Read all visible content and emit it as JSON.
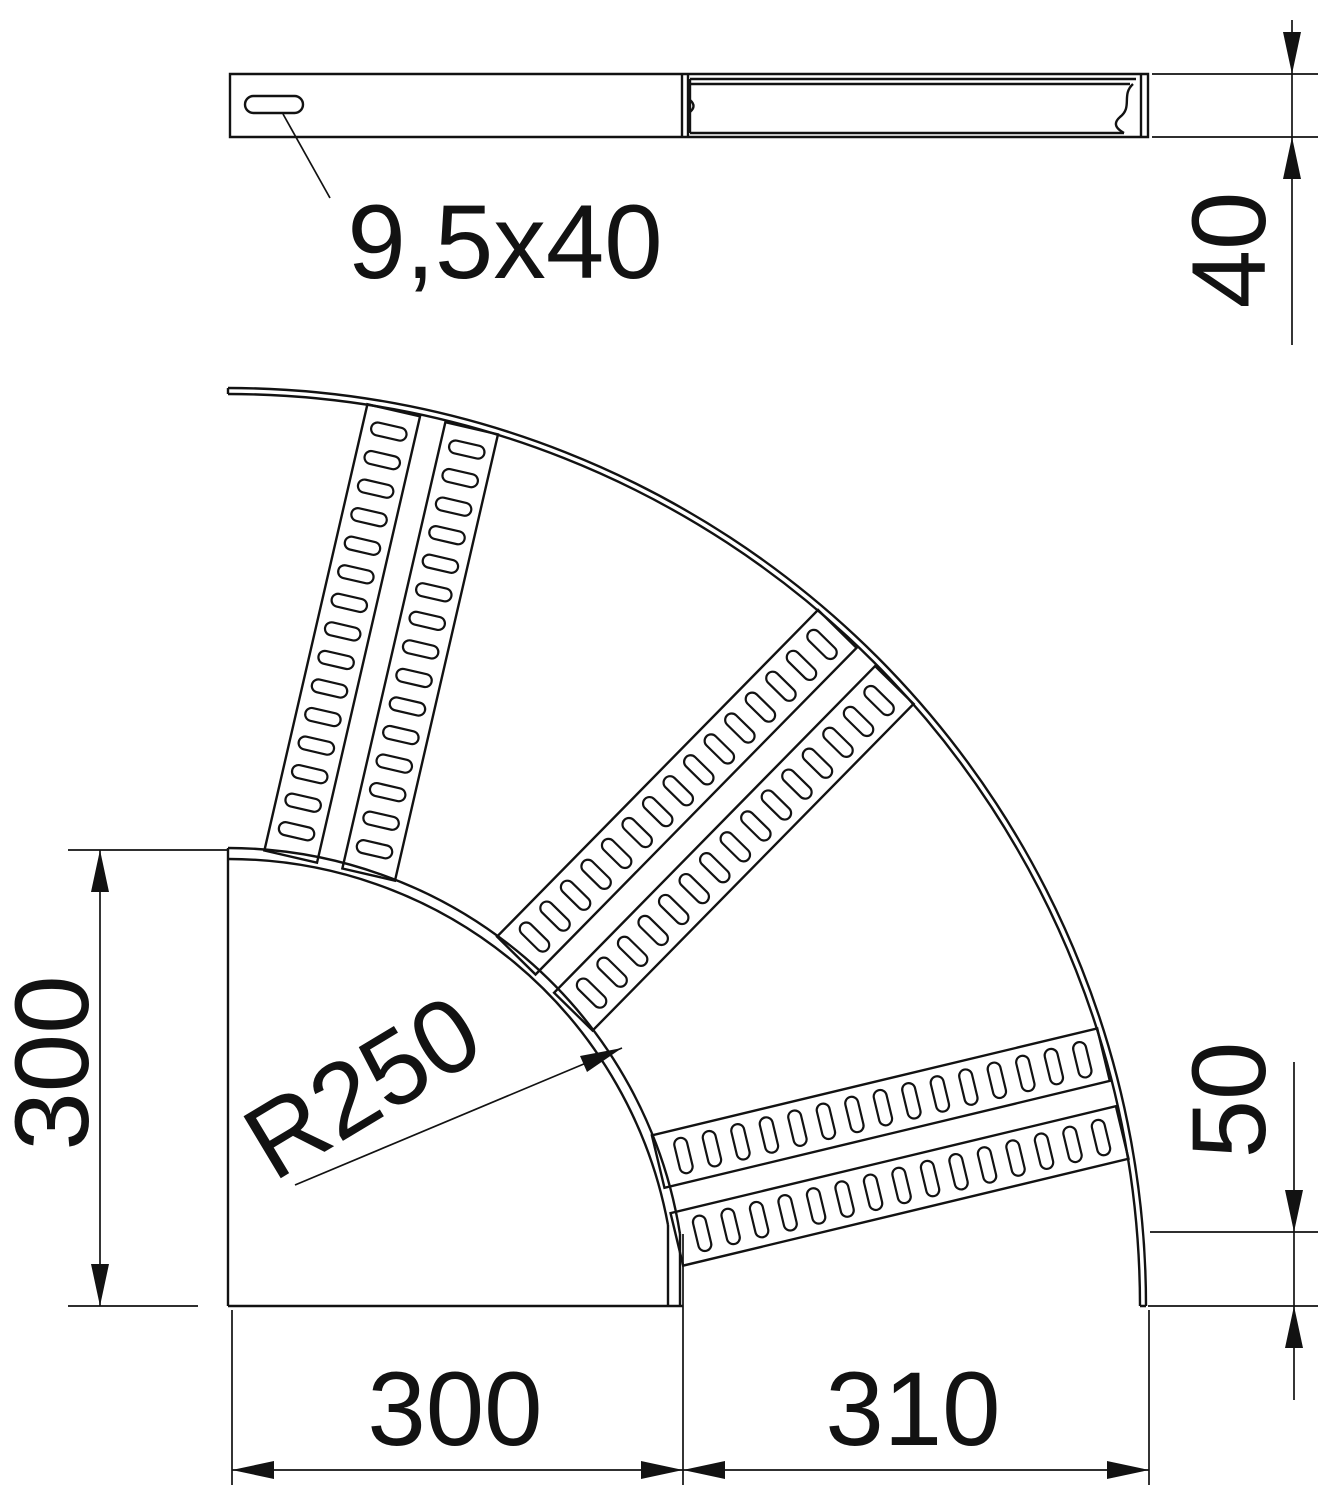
{
  "drawing": {
    "title_hint": "90 degree cable-ladder bend, plan and side view",
    "ink_color": "#121212",
    "background_color": "#ffffff",
    "labels": {
      "slot": "9,5x40",
      "rail_height": "40",
      "side_width": "300",
      "bottom_left_width": "300",
      "bottom_right_width": "310",
      "end_straight": "50",
      "radius": "R250"
    }
  }
}
